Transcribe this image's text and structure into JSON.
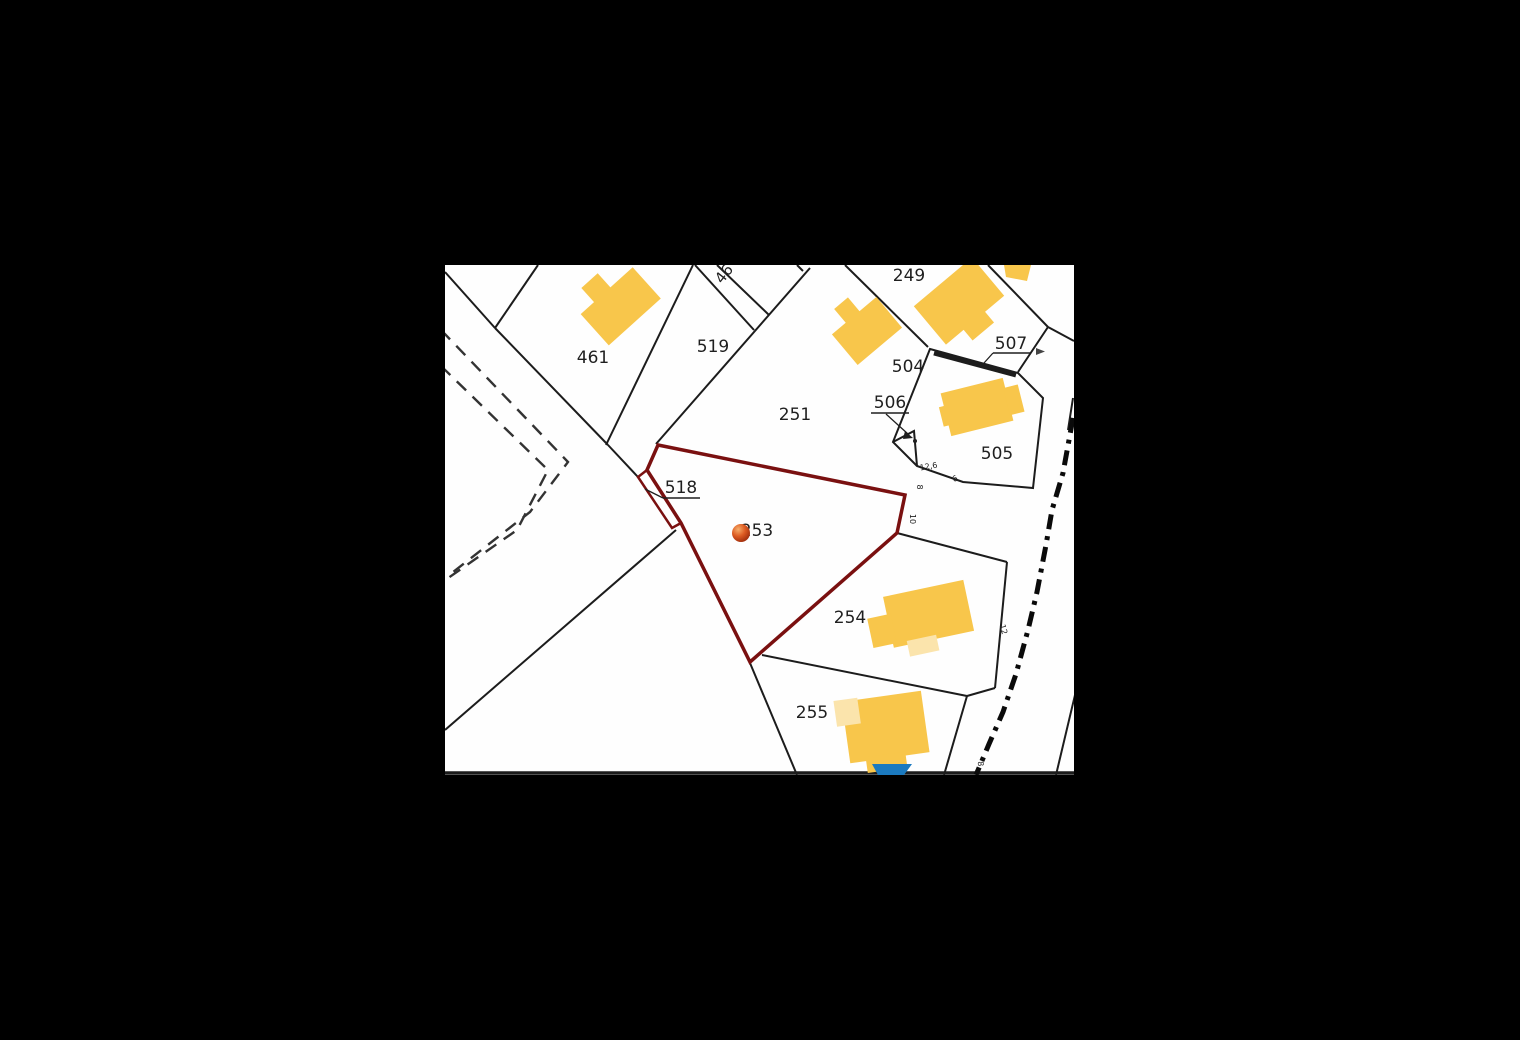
{
  "canvas": {
    "width": 1520,
    "height": 1040,
    "background": "#000000"
  },
  "map": {
    "name": "cadastral-parcel-map",
    "x": 445,
    "y": 265,
    "width": 629,
    "height": 510,
    "background": "#fefefe",
    "style": {
      "parcel_line_color": "#1c1c1c",
      "parcel_line_width": 2,
      "highlight_color": "#7A1010",
      "highlight_width": 3.5,
      "building_fill": "#F8C64B",
      "building_pale_fill": "#FBE4AC",
      "pool_fill": "#1B7AC0",
      "dashed_path_color": "#333333",
      "road_center_color": "#0a0a0a",
      "label_color": "#1f1f1f",
      "tiny_label_color": "#222222",
      "marker_colors": [
        "#F6AE6B",
        "#DD5B22",
        "#8E1F05"
      ]
    },
    "parcel_lines": [
      {
        "name": "boundary-topleft-a",
        "pts": [
          [
            445,
            272
          ],
          [
            495,
            328
          ]
        ]
      },
      {
        "name": "boundary-topleft-b",
        "pts": [
          [
            495,
            328
          ],
          [
            538,
            265
          ]
        ]
      },
      {
        "name": "boundary-461-south",
        "pts": [
          [
            495,
            328
          ],
          [
            608,
            445
          ]
        ]
      },
      {
        "name": "boundary-519-west",
        "pts": [
          [
            693,
            265
          ],
          [
            606,
            445
          ]
        ]
      },
      {
        "name": "boundary-junction-stub",
        "pts": [
          [
            608,
            445
          ],
          [
            638,
            477
          ]
        ]
      },
      {
        "name": "boundary-519-east",
        "pts": [
          [
            810,
            268
          ],
          [
            656,
            444
          ]
        ]
      },
      {
        "name": "boundary-46-strip-west",
        "pts": [
          [
            695,
            265
          ],
          [
            754,
            330
          ]
        ]
      },
      {
        "name": "boundary-46-strip-east",
        "pts": [
          [
            717,
            265
          ],
          [
            769,
            315
          ]
        ]
      },
      {
        "name": "boundary-249-west",
        "pts": [
          [
            845,
            265
          ],
          [
            928,
            347
          ]
        ]
      },
      {
        "name": "boundary-249-east",
        "pts": [
          [
            988,
            265
          ],
          [
            1048,
            327
          ]
        ]
      },
      {
        "name": "boundary-ne-corner",
        "pts": [
          [
            1048,
            327
          ],
          [
            1074,
            341
          ]
        ]
      },
      {
        "name": "boundary-507-link",
        "pts": [
          [
            1048,
            327
          ],
          [
            1018,
            372
          ]
        ]
      },
      {
        "name": "boundary-505-outline",
        "pts": [
          [
            930,
            349
          ],
          [
            1018,
            373
          ],
          [
            1043,
            398
          ],
          [
            1033,
            488
          ],
          [
            963,
            482
          ],
          [
            917,
            466
          ],
          [
            893,
            442
          ]
        ],
        "closed": true
      },
      {
        "name": "boundary-506-triangle",
        "pts": [
          [
            893,
            442
          ],
          [
            914,
            431
          ],
          [
            917,
            466
          ]
        ]
      },
      {
        "name": "boundary-254-north",
        "pts": [
          [
            897,
            533
          ],
          [
            1007,
            562
          ]
        ]
      },
      {
        "name": "boundary-254-east",
        "pts": [
          [
            1007,
            562
          ],
          [
            995,
            688
          ]
        ]
      },
      {
        "name": "boundary-254-southeast",
        "pts": [
          [
            995,
            688
          ],
          [
            967,
            696
          ]
        ]
      },
      {
        "name": "boundary-254-255",
        "pts": [
          [
            967,
            696
          ],
          [
            762,
            655
          ]
        ]
      },
      {
        "name": "boundary-255-west",
        "pts": [
          [
            750,
            663
          ],
          [
            797,
            775
          ]
        ]
      },
      {
        "name": "boundary-255-east",
        "pts": [
          [
            967,
            696
          ],
          [
            944,
            775
          ]
        ]
      },
      {
        "name": "boundary-southwest-diagonal",
        "pts": [
          [
            676,
            530
          ],
          [
            445,
            730
          ]
        ]
      },
      {
        "name": "road-east-edge-top",
        "pts": [
          [
            1073,
            398
          ],
          [
            1068,
            430
          ]
        ]
      },
      {
        "name": "road-east-edge-bottom",
        "pts": [
          [
            1075,
            695
          ],
          [
            1056,
            775
          ]
        ]
      },
      {
        "name": "map-bottom-edge",
        "pts": [
          [
            445,
            773
          ],
          [
            1074,
            773
          ]
        ],
        "w": 3.5
      },
      {
        "name": "cut-label-fragment",
        "pts": [
          [
            797,
            265
          ],
          [
            803,
            271
          ]
        ]
      }
    ],
    "thick_lines": [
      {
        "name": "parcel-507-sliver-line",
        "pts": [
          [
            934,
            353
          ],
          [
            1016,
            375
          ]
        ],
        "w": 5
      }
    ],
    "dashed_paths": [
      {
        "name": "footpath-dashed-outer",
        "pts": [
          [
            441,
            330
          ],
          [
            568,
            462
          ],
          [
            530,
            512
          ],
          [
            448,
            576
          ]
        ]
      },
      {
        "name": "footpath-dashed-inner",
        "pts": [
          [
            441,
            366
          ],
          [
            548,
            470
          ],
          [
            517,
            530
          ],
          [
            441,
            583
          ]
        ]
      }
    ],
    "road_centerline": {
      "name": "road-centerline-dashdot",
      "pts": [
        [
          1073,
          418
        ],
        [
          1063,
          473
        ],
        [
          1052,
          510
        ],
        [
          1046,
          545
        ],
        [
          1037,
          592
        ],
        [
          1028,
          630
        ],
        [
          1016,
          674
        ],
        [
          1003,
          712
        ],
        [
          989,
          744
        ],
        [
          976,
          775
        ]
      ],
      "dash": "15 7 4 7",
      "w": 5
    },
    "highlight": {
      "name": "selected-parcel-253-boundary",
      "polygon": [
        [
          658,
          445
        ],
        [
          905,
          495
        ],
        [
          897,
          533
        ],
        [
          750,
          662
        ],
        [
          681,
          523
        ],
        [
          647,
          470
        ]
      ],
      "sliver_name": "parcel-518-sliver-boundary",
      "sliver": [
        [
          647,
          470
        ],
        [
          638,
          477
        ],
        [
          672,
          528
        ],
        [
          681,
          523
        ]
      ]
    },
    "buildings": [
      {
        "name": "building-parcel-461",
        "rotate": [
          -42,
          620,
          307
        ],
        "rects": [
          [
            586,
            286,
            70,
            42
          ],
          [
            604,
            267,
            22,
            21
          ]
        ]
      },
      {
        "name": "building-parcel-504",
        "rotate": [
          -40,
          867,
          331
        ],
        "rects": [
          [
            838,
            311,
            58,
            40
          ],
          [
            856,
            293,
            18,
            20
          ]
        ]
      },
      {
        "name": "building-parcel-249",
        "rotate": [
          -40,
          959,
          301
        ],
        "rects": [
          [
            921,
            276,
            76,
            50
          ],
          [
            944,
            324,
            28,
            16
          ]
        ]
      },
      {
        "name": "building-parcel-505",
        "rotate": [
          -14,
          977,
          407
        ],
        "rects": [
          [
            945,
            385,
            64,
            44
          ],
          [
            1007,
            395,
            15,
            28
          ],
          [
            940,
            398,
            10,
            20
          ]
        ]
      },
      {
        "name": "building-top-right-corner",
        "rotate": [
          0,
          0,
          0
        ],
        "polys": [
          [
            [
              1004,
              265
            ],
            [
              1031,
              265
            ],
            [
              1027,
              281
            ],
            [
              1006,
              277
            ]
          ]
        ]
      },
      {
        "name": "building-parcel-254",
        "rotate": [
          -12,
          928,
          616
        ],
        "rects": [
          [
            888,
            588,
            82,
            52
          ],
          [
            868,
            606,
            24,
            30
          ]
        ],
        "pale_rects": [
          [
            902,
            636,
            30,
            16
          ]
        ]
      },
      {
        "name": "building-parcel-255",
        "rotate": [
          -8,
          886,
          730
        ],
        "rects": [
          [
            846,
            696,
            80,
            62
          ],
          [
            862,
            754,
            40,
            16
          ]
        ],
        "pale_rects": [
          [
            838,
            694,
            24,
            26
          ]
        ]
      }
    ],
    "pool": {
      "name": "pool-blue",
      "pts": [
        [
          872,
          764
        ],
        [
          912,
          764
        ],
        [
          904,
          775
        ],
        [
          878,
          775
        ]
      ]
    },
    "marker": {
      "name": "selected-parcel-marker",
      "cx": 741,
      "cy": 533,
      "r": 9
    },
    "labels": [
      {
        "name": "parcel-label-461",
        "text": "461",
        "x": 593,
        "y": 363,
        "size": 17
      },
      {
        "name": "parcel-label-519",
        "text": "519",
        "x": 713,
        "y": 352,
        "size": 17
      },
      {
        "name": "parcel-label-251",
        "text": "251",
        "x": 795,
        "y": 420,
        "size": 17
      },
      {
        "name": "parcel-label-249",
        "text": "249",
        "x": 909,
        "y": 281,
        "size": 17
      },
      {
        "name": "parcel-label-504",
        "text": "504",
        "x": 908,
        "y": 372,
        "size": 17
      },
      {
        "name": "parcel-label-507",
        "text": "507",
        "x": 1011,
        "y": 349,
        "size": 17,
        "underline": [
          993,
          353,
          1030,
          353
        ]
      },
      {
        "name": "parcel-label-506",
        "text": "506",
        "x": 890,
        "y": 408,
        "size": 17,
        "underline": [
          871,
          413,
          909,
          413
        ]
      },
      {
        "name": "parcel-label-505",
        "text": "505",
        "x": 997,
        "y": 459,
        "size": 17
      },
      {
        "name": "parcel-label-518",
        "text": "518",
        "x": 681,
        "y": 493,
        "size": 17,
        "underline": [
          663,
          498,
          700,
          498
        ]
      },
      {
        "name": "parcel-label-253",
        "text": "253",
        "x": 757,
        "y": 536,
        "size": 17
      },
      {
        "name": "parcel-label-254",
        "text": "254",
        "x": 850,
        "y": 623,
        "size": 17
      },
      {
        "name": "parcel-label-255",
        "text": "255",
        "x": 812,
        "y": 718,
        "size": 17
      },
      {
        "name": "parcel-label-46-clipped",
        "text": "46",
        "x": 728,
        "y": 277,
        "size": 15,
        "rotate": -52
      }
    ],
    "tiny_labels": [
      {
        "name": "dimension-12-6",
        "text": "12,6",
        "x": 929,
        "y": 469,
        "size": 8,
        "rotate": -10
      },
      {
        "name": "housenumber-8",
        "text": "8",
        "x": 917,
        "y": 487,
        "size": 8,
        "rotate": 90
      },
      {
        "name": "housenumber-6",
        "text": "6",
        "x": 956,
        "y": 481,
        "size": 8,
        "rotate": -25
      },
      {
        "name": "housenumber-10",
        "text": "10",
        "x": 910,
        "y": 519,
        "size": 8,
        "rotate": 90
      },
      {
        "name": "housenumber-12",
        "text": "12",
        "x": 1001,
        "y": 630,
        "size": 8,
        "rotate": 75
      },
      {
        "name": "housenumber-8b",
        "text": "8",
        "x": 978,
        "y": 764,
        "size": 8,
        "rotate": 85
      }
    ],
    "leaders": [
      {
        "name": "leader-518",
        "pts": [
          [
            663,
            498
          ],
          [
            645,
            489
          ]
        ]
      },
      {
        "name": "leader-507",
        "pts": [
          [
            993,
            353
          ],
          [
            984,
            363
          ]
        ]
      },
      {
        "name": "leader-506",
        "pts": [
          [
            886,
            414
          ],
          [
            908,
            434
          ]
        ]
      }
    ],
    "arrows": [
      {
        "name": "leader-506-arrowhead",
        "pts": [
          [
            905,
            431
          ],
          [
            913,
            438
          ],
          [
            903,
            439
          ]
        ],
        "fill": "#1f1f1f"
      },
      {
        "name": "roadside-arrow-mark",
        "pts": [
          [
            1036,
            348
          ],
          [
            1045,
            351.5
          ],
          [
            1036,
            355
          ]
        ],
        "fill": "#444444"
      }
    ],
    "dots": [
      {
        "name": "leader-506-endpoint-dot",
        "x": 915,
        "y": 441,
        "r": 2
      }
    ]
  }
}
